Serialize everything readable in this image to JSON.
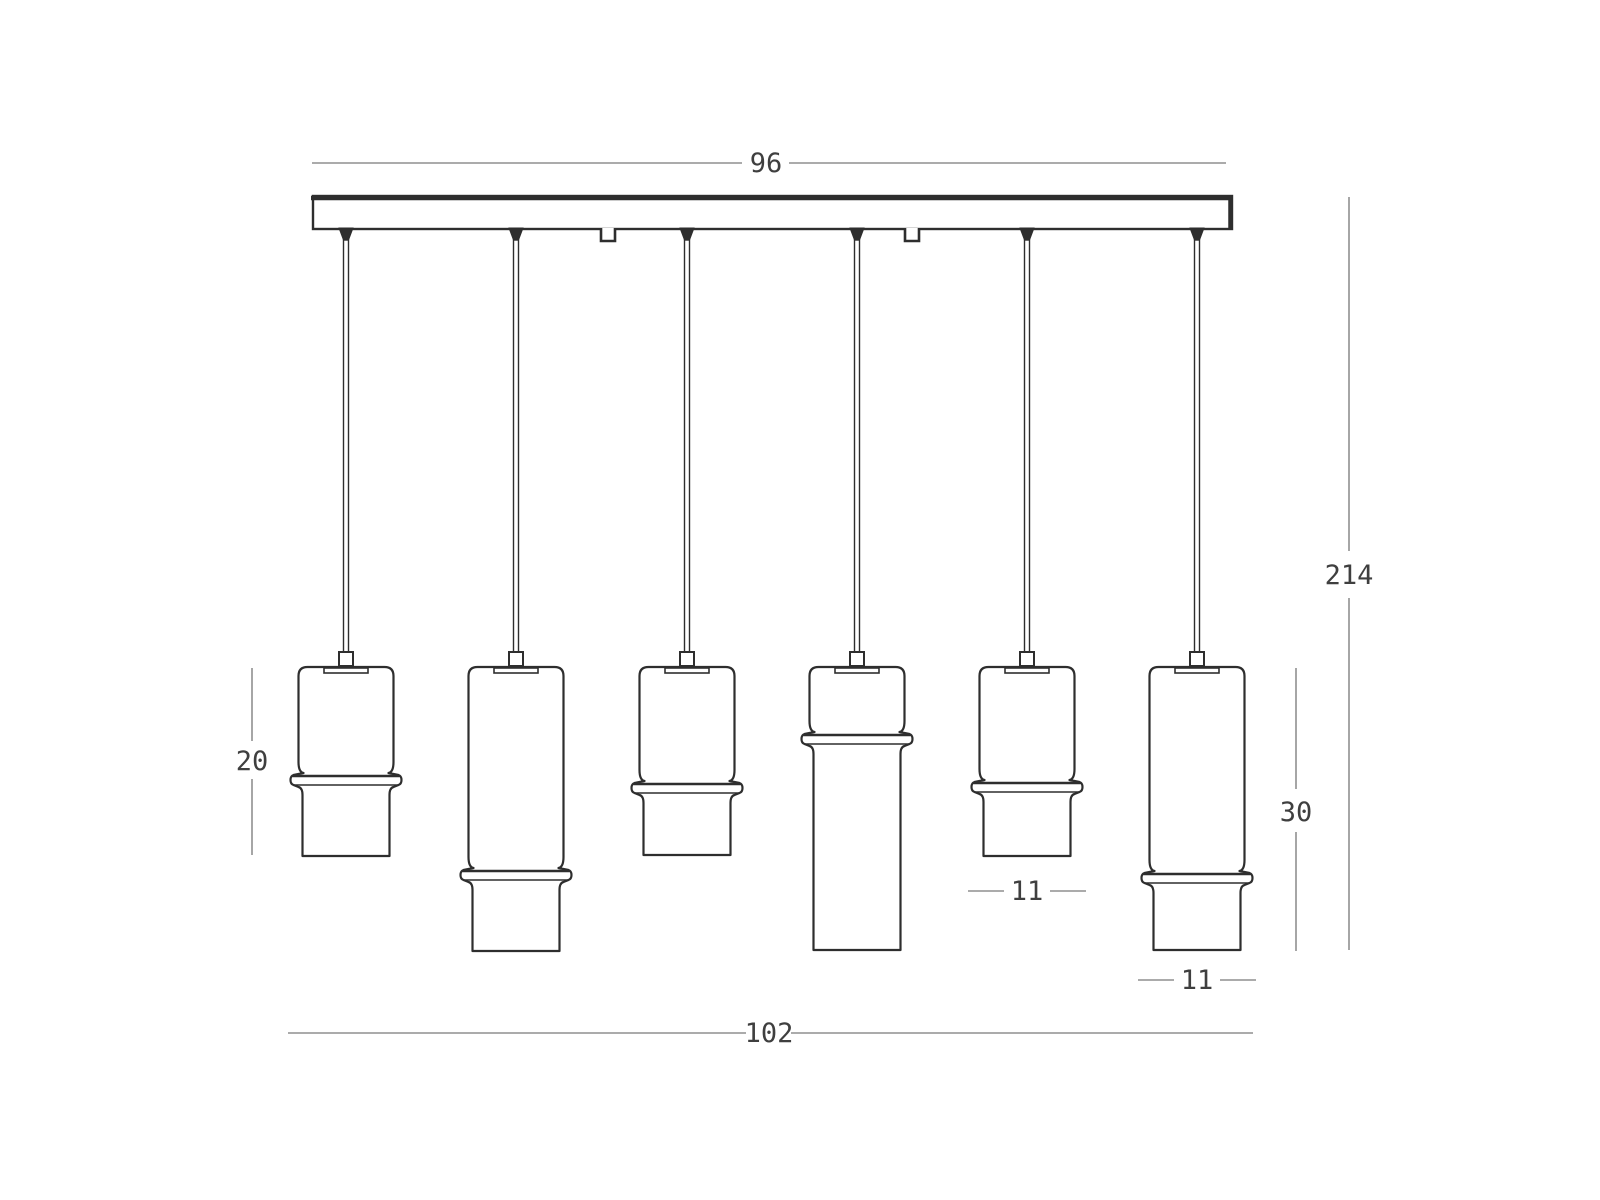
{
  "figure": {
    "type": "technical-line-drawing",
    "subject": "six-light linear pendant fixture, front elevation with dimensions",
    "background_color": "#ffffff",
    "outline_color": "#2e2e2e",
    "dim_line_color": "#8f8f8f",
    "dim_text_color": "#3f3f3f",
    "dimensions": {
      "canopy_width": "96",
      "overall_drop": "214",
      "short_shade_height": "20",
      "long_shade_height": "30",
      "shade_diameter_a": "11",
      "shade_diameter_b": "11",
      "overall_width": "102"
    },
    "canopy": {
      "x": 313,
      "y": 196,
      "width": 919,
      "height": 33
    },
    "shade_top_y": 667,
    "pendants": [
      {
        "cx": 346,
        "collar_y": 775,
        "bottom_y": 856
      },
      {
        "cx": 516,
        "collar_y": 870,
        "bottom_y": 951
      },
      {
        "cx": 687,
        "collar_y": 783,
        "bottom_y": 855
      },
      {
        "cx": 857,
        "collar_y": 734,
        "bottom_y": 950
      },
      {
        "cx": 1027,
        "collar_y": 782,
        "bottom_y": 856
      },
      {
        "cx": 1197,
        "collar_y": 873,
        "bottom_y": 950
      }
    ],
    "hooks_x": [
      608,
      912
    ]
  }
}
